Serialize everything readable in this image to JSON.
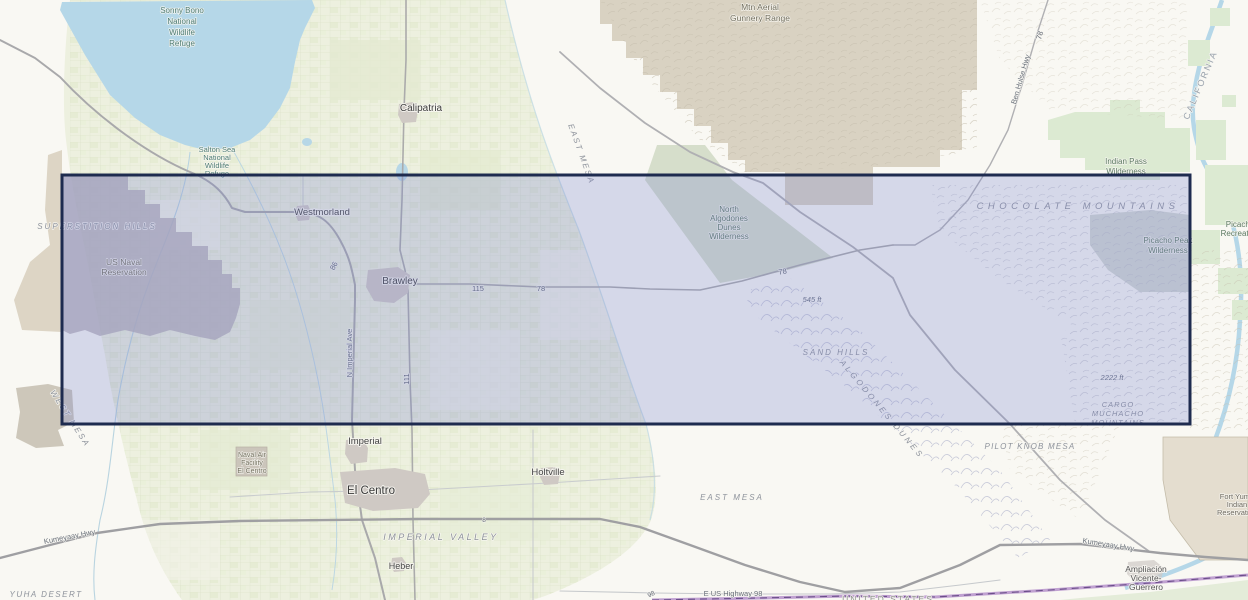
{
  "selection": {
    "border_color": "#1e2b4f",
    "fill_color": "#7782cf"
  },
  "colors": {
    "desert_base": "#f9f8f3",
    "water": "#b5d7e8",
    "farmland": "#edf0df",
    "military_tan": "#d9d2c2",
    "reservation_gray": "#b6b0b6",
    "wilderness_green": "#dcead2",
    "dunes_wedge_green": "#d6decb",
    "fort_yuma_beige": "#e4ddcf",
    "border_purple": "#b28bc8",
    "road_major": "#a9a9ab",
    "road_minor": "#c9ccce"
  },
  "labels": {
    "sonny_bono": [
      "Sonny Bono",
      "National",
      "Wildlife",
      "Refuge"
    ],
    "salton_nwr": [
      "Salton Sea",
      "National",
      "Wildlife",
      "Refuge"
    ],
    "calipatria": "Calipatria",
    "mtn_aerial": [
      "Mtn Aerial",
      "Gunnery Range"
    ],
    "east_mesa_upper": "EAST MESA",
    "ben_hulse": "Ben Hulse Hwy",
    "hwy78_top": "78",
    "california": "CALIFORNIA",
    "indian_pass": [
      "Indian Pass",
      "Wilderness"
    ],
    "picacho_rec": [
      "Picacho",
      "Recreation"
    ],
    "chocolate": "CHOCOLATE MOUNTAINS",
    "picacho_peak": [
      "Picacho Peak",
      "Wilderness"
    ],
    "superstition": "SUPERSTITION HILLS",
    "us_naval": [
      "US Naval",
      "Reservation"
    ],
    "westmorland": "Westmorland",
    "hwy86": "86",
    "brawley": "Brawley",
    "imperial_ave": "N Imperial Ave",
    "hwy111": "111",
    "hwy115": "115",
    "hwy78_mid": "78",
    "north_algodones": [
      "North",
      "Algodones",
      "Dunes",
      "Wilderness"
    ],
    "hwy78_east": "78",
    "elev_545": "545 ft",
    "sand_hills": "SAND HILLS",
    "algodones_dunes": "ALGODONES DUNES",
    "pilot_knob": "PILOT KNOB MESA",
    "elev_2222": "2222 ft",
    "cargo": [
      "CARGO",
      "MUCHACHO",
      "MOUNTAINS"
    ],
    "imperial": "Imperial",
    "naval_air": [
      "Naval Air",
      "Facility",
      "El Centro"
    ],
    "el_centro": "El Centro",
    "holtville": "Holtville",
    "imperial_valley": "IMPERIAL VALLEY",
    "heber": "Heber",
    "i8": "8",
    "west_mesa": "WEST MESA",
    "kumeyaay_left": "Kumeyaay Hwy",
    "yuha": "YUHA DESERT",
    "kumeyaay_right": "Kumeyaay Hwy",
    "fort_yuma": [
      "Fort Yuma",
      "Indian",
      "Reservation"
    ],
    "amplacion": [
      "Ampliación",
      "Vicente-",
      "Guerrero"
    ],
    "us98": "E US Highway 98",
    "n98": "98",
    "united_states": "UNITED STATES",
    "east_mesa_lower": "EAST MESA"
  }
}
